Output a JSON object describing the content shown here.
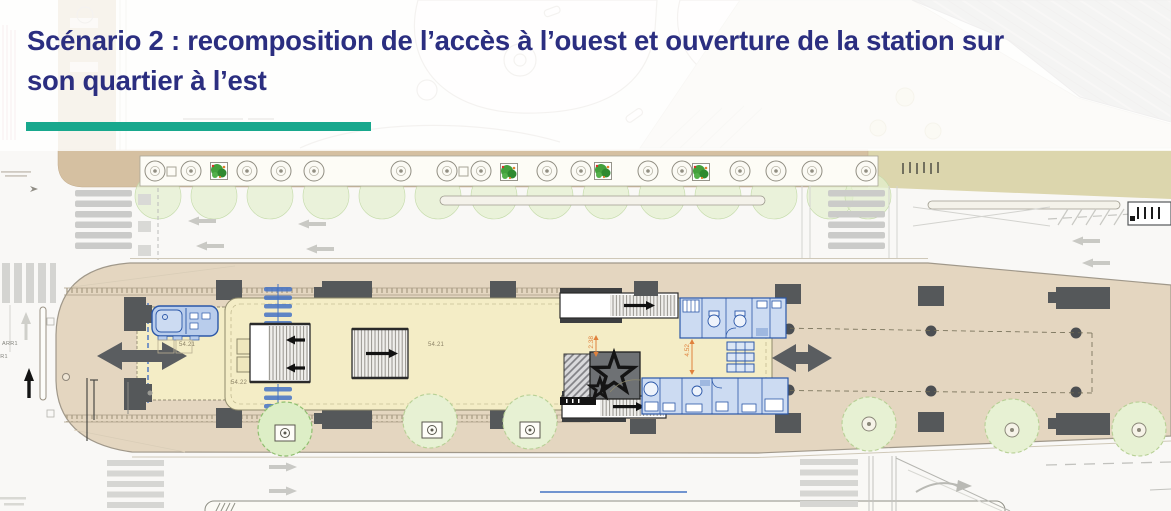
{
  "header": {
    "title_line1": "Scénario 2 : recomposition de l’accès à l’ouest et ouverture de la station sur",
    "title_line2": "son quartier à l’est"
  },
  "plan": {
    "levels": {
      "west": "54.21",
      "hall": "54.21",
      "lower": "54.22"
    },
    "bus_stop": {
      "primary": "ARR1",
      "secondary": "ARR1"
    },
    "dimensions": {
      "width_north": "2.38",
      "width_east": "4.52"
    }
  },
  "icons": {
    "pedestrian_flow_west": "double-headed-arrow-icon",
    "pedestrian_flow_east": "double-headed-arrow-icon",
    "artwork": "star-icon",
    "escalators": "striped-ramp-with-direction-arrow-icon",
    "trees": "tree-ring-icon"
  },
  "colors": {
    "title_navy": "#2b2e80",
    "accent_teal": "#18a88d",
    "sidewalk_tan": "#d5c0a1",
    "parking_khaki": "#dcd6ad",
    "island_beige": "#e4d6c0",
    "station_yellow": "#f4edc6",
    "equipment_blue": "#2b57a8",
    "equipment_blue_fill": "#ccdbf2",
    "structure_gray": "#55585a",
    "tree_green_fill": "#e7f1d3",
    "tree_green_line": "#b7d095",
    "dimension_orange": "#e0813c",
    "annotation_blue": "#4472c4"
  }
}
